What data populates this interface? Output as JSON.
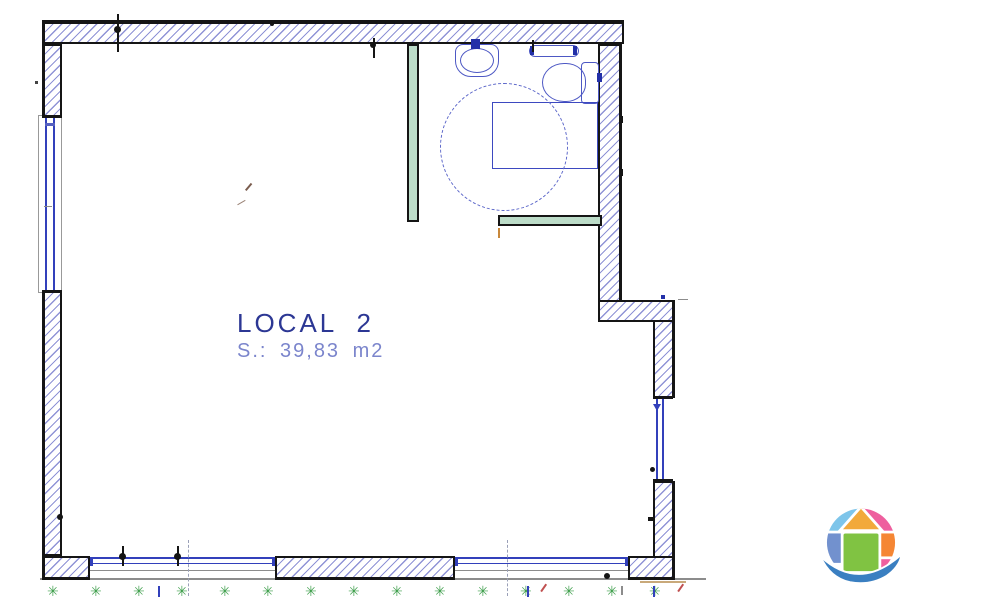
{
  "drawing": {
    "title": "LOCAL 2 floor plan",
    "room": {
      "label": "LOCAL 2",
      "area": "S.: 39,83 m2"
    }
  },
  "palette": {
    "wall_hatch": "#8f93d6",
    "wall_outline": "#151515",
    "window_blue": "#3240bb",
    "fixture_blue": "#4d58c4",
    "turning_circle_blue": "#5b66c9",
    "partition_green": "#bcdcc8",
    "label_primary": "#2c3794",
    "label_secondary": "#7b85cc",
    "plant_green": "#3f9f4c",
    "accent_orange": "#c8883c",
    "accent_tan": "#c9a97a",
    "accent_red": "#c05050",
    "gray_line": "#8c8c8c"
  },
  "ground": {
    "plant_symbol": "✳",
    "plant_positions": [
      47,
      90,
      133,
      176,
      219,
      262,
      305,
      348,
      391,
      434,
      477,
      520,
      563,
      606,
      649
    ],
    "blue_tick_positions": [
      158,
      527,
      653
    ],
    "red_slash_positions": [
      539,
      676
    ],
    "gray_tick_positions": [
      621
    ],
    "axis_line_positions": [
      188,
      507
    ]
  },
  "logo": {
    "name": "globe-house-logo",
    "colors": {
      "top_left": "#7ec5ea",
      "roof": "#f2a93b",
      "top_right": "#ee5f9e",
      "left": "#7291ce",
      "center": "#80c342",
      "right": "#f58634",
      "bottom_right": "#ee5f9e",
      "swoosh": "#3a7fc1"
    }
  }
}
